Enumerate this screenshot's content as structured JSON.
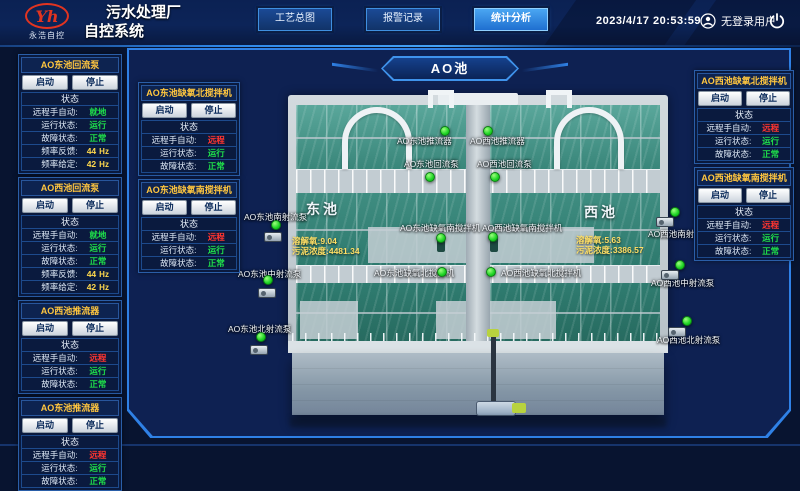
{
  "header": {
    "brand": {
      "monogram": "Yh",
      "name": "永浩自控"
    },
    "title_line1": "污水处理厂",
    "title_line2": "自控系统",
    "nav": [
      {
        "label": "工艺总图",
        "active": false
      },
      {
        "label": "报警记录",
        "active": false
      },
      {
        "label": "统计分析",
        "active": true
      }
    ],
    "datetime": "2023/4/17 20:53:59",
    "user_label": "无登录用户"
  },
  "common": {
    "start": "启动",
    "stop": "停止",
    "status": "状态"
  },
  "scene": {
    "badge": "AO池",
    "pools": [
      {
        "name": "东池",
        "stats": [
          {
            "label": "溶解氧:",
            "value": "9.04"
          },
          {
            "label": "污泥浓度:",
            "value": "4481.34"
          }
        ]
      },
      {
        "name": "西池",
        "stats": [
          {
            "label": "溶解氧:",
            "value": "5.63"
          },
          {
            "label": "污泥浓度:",
            "value": "3386.57"
          }
        ]
      }
    ],
    "markers": [
      "AO东池推流器",
      "AO西池推流器",
      "AO东池回流泵",
      "AO西池回流泵",
      "AO东池南射流泵",
      "AO东池中射流泵",
      "AO东池北射流泵",
      "AO东池缺氧南搅拌机",
      "AO西池缺氧南搅拌机",
      "AO东池缺氧北搅拌机",
      "AO西池缺氧北搅拌机",
      "AO西池南射流泵",
      "AO西池中射流泵",
      "AO西池北射流泵"
    ]
  },
  "panels": {
    "left_outer": [
      {
        "title": "AO东池回流泵",
        "rows": [
          {
            "label": "远程手自动:",
            "value": "就地",
            "state": "ok"
          },
          {
            "label": "运行状态:",
            "value": "运行",
            "state": "ok"
          },
          {
            "label": "故障状态:",
            "value": "正常",
            "state": "ok"
          },
          {
            "label": "频率反馈:",
            "value": "44",
            "unit": "Hz",
            "state": "num"
          },
          {
            "label": "频率给定:",
            "value": "42",
            "unit": "Hz",
            "state": "num"
          }
        ]
      },
      {
        "title": "AO西池回流泵",
        "rows": [
          {
            "label": "远程手自动:",
            "value": "就地",
            "state": "ok"
          },
          {
            "label": "运行状态:",
            "value": "运行",
            "state": "ok"
          },
          {
            "label": "故障状态:",
            "value": "正常",
            "state": "ok"
          },
          {
            "label": "频率反馈:",
            "value": "44",
            "unit": "Hz",
            "state": "num"
          },
          {
            "label": "频率给定:",
            "value": "42",
            "unit": "Hz",
            "state": "num"
          }
        ]
      },
      {
        "title": "AO西池推流器",
        "rows": [
          {
            "label": "远程手自动:",
            "value": "远程",
            "state": "alert"
          },
          {
            "label": "运行状态:",
            "value": "运行",
            "state": "ok"
          },
          {
            "label": "故障状态:",
            "value": "正常",
            "state": "ok"
          }
        ]
      },
      {
        "title": "AO东池推流器",
        "rows": [
          {
            "label": "远程手自动:",
            "value": "远程",
            "state": "alert"
          },
          {
            "label": "运行状态:",
            "value": "运行",
            "state": "ok"
          },
          {
            "label": "故障状态:",
            "value": "正常",
            "state": "ok"
          }
        ]
      }
    ],
    "left_inner": [
      {
        "title": "AO东池缺氧北搅拌机",
        "rows": [
          {
            "label": "远程手自动:",
            "value": "远程",
            "state": "alert"
          },
          {
            "label": "运行状态:",
            "value": "运行",
            "state": "ok"
          },
          {
            "label": "故障状态:",
            "value": "正常",
            "state": "ok"
          }
        ]
      },
      {
        "title": "AO东池缺氧南搅拌机",
        "rows": [
          {
            "label": "远程手自动:",
            "value": "远程",
            "state": "alert"
          },
          {
            "label": "运行状态:",
            "value": "运行",
            "state": "ok"
          },
          {
            "label": "故障状态:",
            "value": "正常",
            "state": "ok"
          }
        ]
      }
    ],
    "right": [
      {
        "title": "AO西池缺氧北搅拌机",
        "rows": [
          {
            "label": "远程手自动:",
            "value": "远程",
            "state": "alert"
          },
          {
            "label": "运行状态:",
            "value": "运行",
            "state": "ok"
          },
          {
            "label": "故障状态:",
            "value": "正常",
            "state": "ok"
          }
        ]
      },
      {
        "title": "AO西池缺氧南搅拌机",
        "rows": [
          {
            "label": "远程手自动:",
            "value": "远程",
            "state": "alert"
          },
          {
            "label": "运行状态:",
            "value": "运行",
            "state": "ok"
          },
          {
            "label": "故障状态:",
            "value": "正常",
            "state": "ok"
          }
        ]
      }
    ]
  },
  "colors": {
    "ok": "#1fe04a",
    "alert": "#ff3530",
    "num": "#ffd94d",
    "accent": "#2f87e8",
    "title_yellow": "#ffc63f"
  }
}
